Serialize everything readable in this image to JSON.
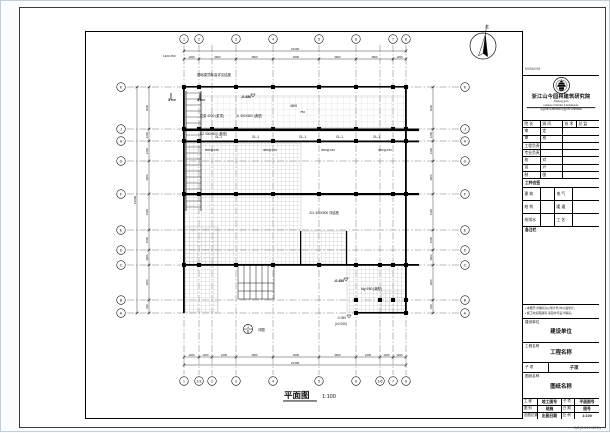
{
  "plan": {
    "title": "平面图",
    "scale": "1:100",
    "sheet_size_label": "A2(594X420)"
  },
  "compass": {
    "north_label": "北"
  },
  "axes": {
    "top_labels": [
      "1",
      "2",
      "3",
      "4",
      "5",
      "6",
      "7",
      "8"
    ],
    "bottom_labels": [
      "1",
      "1/1",
      "2",
      "3",
      "4",
      "5",
      "6",
      "1/6",
      "7",
      "8"
    ],
    "side_labels": [
      "K",
      "J",
      "H",
      "G",
      "F",
      "E",
      "D",
      "C",
      "B",
      "A"
    ]
  },
  "dimensions": {
    "top_total": "21300",
    "top_segments": [
      "1200",
      "3600",
      "3600",
      "4500",
      "3600",
      "3600",
      "1200"
    ],
    "bottom_total": "21300",
    "bottom_segments": [
      "1200",
      "1200",
      "2400",
      "3600",
      "4500",
      "3600",
      "2400",
      "1200",
      "1200"
    ],
    "left_total": "21600",
    "left_segments": [
      "6000",
      "1200",
      "2100",
      "3300",
      "2100",
      "1500",
      "3600",
      "1200",
      "600"
    ],
    "right_segments": [
      "6000",
      "1200",
      "2100",
      "3300",
      "2100",
      "1500",
      "3600",
      "1200",
      "600"
    ]
  },
  "annotations": [
    {
      "t": "基础梁顶标高详见结施",
      "x": 196,
      "y": 75,
      "s": 3.4
    },
    {
      "t": "1200 450",
      "x": 162,
      "y": 56,
      "s": 3
    },
    {
      "t": "-0.450",
      "x": 240,
      "y": 97,
      "s": 3.6,
      "b": 1
    },
    {
      "t": "4500",
      "x": 289,
      "y": 106,
      "s": 3.2
    },
    {
      "t": "750",
      "x": 299,
      "y": 112,
      "s": 3
    },
    {
      "t": "拉梁 4200 (梁顶)",
      "x": 199,
      "y": 116,
      "s": 3.2
    },
    {
      "t": "JL 300X500 (典型)",
      "x": 235,
      "y": 116,
      "s": 3.2
    },
    {
      "t": "KZ 300X500 (典型)",
      "x": 199,
      "y": 134,
      "s": 3.2
    },
    {
      "t": "GL-1",
      "x": 214,
      "y": 137,
      "s": 3.2
    },
    {
      "t": "GL-1",
      "x": 251,
      "y": 137,
      "s": 3.2
    },
    {
      "t": "GL-1",
      "x": 298,
      "y": 137,
      "s": 3.2
    },
    {
      "t": "GL-1",
      "x": 335,
      "y": 137,
      "s": 3.2
    },
    {
      "t": "GL-1",
      "x": 372,
      "y": 137,
      "s": 3.2
    },
    {
      "t": "Φ50@150",
      "x": 204,
      "y": 150,
      "s": 3
    },
    {
      "t": "Φ50@150",
      "x": 262,
      "y": 150,
      "s": 3
    },
    {
      "t": "Φ50@150",
      "x": 320,
      "y": 150,
      "s": 3
    },
    {
      "t": "Φ50@150",
      "x": 377,
      "y": 150,
      "s": 3
    },
    {
      "t": "JCL 300X500 详结施",
      "x": 308,
      "y": 213,
      "s": 3.2
    },
    {
      "t": "-0.450",
      "x": 333,
      "y": 281,
      "s": 3.6,
      "b": 1
    },
    {
      "t": "-0.050",
      "x": 336,
      "y": 318,
      "s": 3.2
    },
    {
      "t": "(±0.000)",
      "x": 334,
      "y": 324,
      "s": 3.2
    },
    {
      "t": "Mg Φ50 (典型)",
      "x": 360,
      "y": 289,
      "s": 3.2
    },
    {
      "t": "3",
      "x": 167,
      "y": 100,
      "s": 4,
      "b": 1
    },
    {
      "t": "3",
      "x": 196,
      "y": 100,
      "s": 4,
      "b": 1
    },
    {
      "t": "详图",
      "x": 257,
      "y": 330,
      "s": 3.4
    }
  ],
  "detail_callout": {
    "top": "1",
    "bottom": "B"
  },
  "title_block": {
    "stamp_text": "M09AV98",
    "company": {
      "name": "浙江山今园林建筑研究院",
      "en_line1": "Zhejiang gush",
      "en_line2": "Institute of Garden & Architecture",
      "phone": "电话:0571-8053500 传真:0571-8053530"
    },
    "personnel": {
      "row1": [
        "院 长",
        "顾 问",
        "技 术",
        "总 监"
      ],
      "rows": [
        [
          "审",
          "定"
        ],
        [
          "审",
          "核"
        ],
        [
          "工程负责",
          ""
        ],
        [
          "专业负责",
          ""
        ],
        [
          "校",
          "对"
        ],
        [
          "设",
          "计"
        ],
        [
          "制",
          "图"
        ]
      ]
    },
    "huiqian": {
      "header": "工种会签",
      "rows": [
        [
          "建 筑",
          "",
          "电 气",
          ""
        ],
        [
          "结 构",
          "",
          "暖 通",
          ""
        ],
        [
          "给排水",
          "",
          "工 艺",
          ""
        ]
      ]
    },
    "notes_header": "备注栏",
    "notes": [
      "▪ 本图尺寸除标高以米计外,均以毫米计。",
      "▪ 施工时如有疑问,请及时与设计联系。"
    ],
    "fields": {
      "owner_label": "建设单位",
      "owner_value": "建设单位",
      "project_label": "工程名称",
      "project_value": "工程名称",
      "sub_label": "子 项",
      "sub_value": "子项",
      "drawing_label": "图纸名称",
      "drawing_value": "图纸名称"
    },
    "grid": [
      [
        "工 程",
        "竣工图号",
        "子 项",
        "平面图号"
      ],
      [
        "图 别",
        "结施",
        "日 期",
        "图号"
      ],
      [
        "出图记录",
        "出图日期",
        "比 例",
        "1:100"
      ]
    ]
  }
}
